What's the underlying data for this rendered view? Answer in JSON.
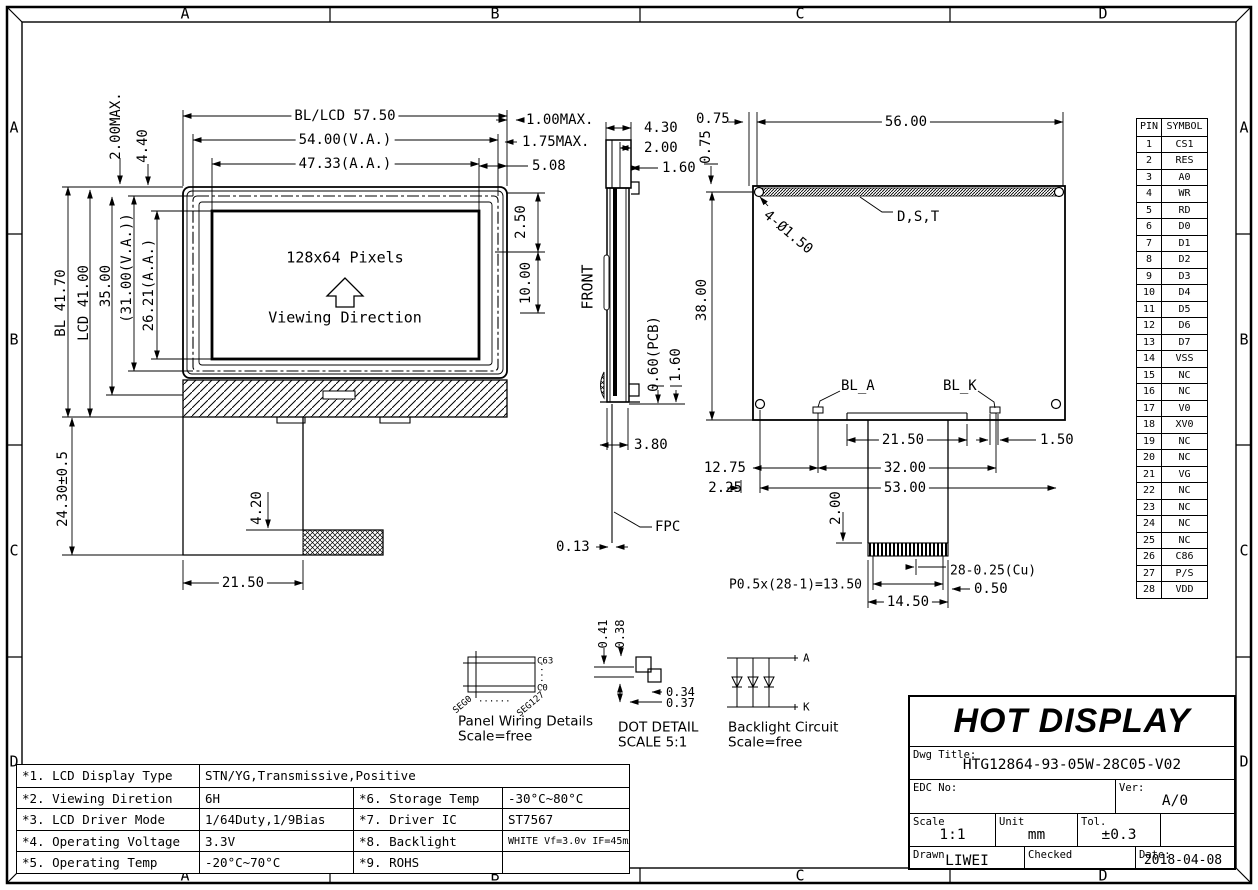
{
  "border": {
    "cols": [
      "A",
      "B",
      "C",
      "D"
    ],
    "rows": [
      "A",
      "B",
      "C",
      "D"
    ]
  },
  "front_view": {
    "screen_line1": "128x64 Pixels",
    "screen_line2": "Viewing Direction",
    "dims": {
      "bl_lcd_w": "BL/LCD 57.50",
      "va_w": "54.00(V.A.)",
      "aa_w": "47.33(A.A.)",
      "top_gap": "2.00MAX.",
      "bezel_top": "4.40",
      "bl_h": "BL 41.70",
      "lcd_h": "LCD 41.00",
      "pcb_h": "35.00",
      "va_h": "(31.00(V.A.))",
      "aa_h": "26.21(A.A.)",
      "tail_len": "24.30±0.5",
      "tail_w": "21.50",
      "conn_h": "4.20"
    }
  },
  "side_view": {
    "label_front": "FRONT",
    "label_fpc": "FPC",
    "dims": {
      "d100": "1.00MAX.",
      "d175": "1.75MAX.",
      "d508": "5.08",
      "d430": "4.30",
      "d200": "2.00",
      "d160": "1.60",
      "d250": "2.50",
      "d1000": "10.00",
      "pcb_t": "0.60(PCB)",
      "total_t": "1.60",
      "d380": "3.80",
      "fpc_t": "0.13"
    }
  },
  "back_view": {
    "labels": {
      "dst": "D,S,T",
      "holes": "4-Ø1.50",
      "bl_a": "BL_A",
      "bl_k": "BL_K"
    },
    "dims": {
      "d075h": "0.75",
      "d075v": "0.75",
      "d5600": "56.00",
      "d3800": "38.00",
      "d2150": "21.50",
      "d150": "1.50",
      "d3200": "32.00",
      "d1275": "12.75",
      "d5300": "53.00",
      "d225": "2.25",
      "d200": "2.00",
      "pitch": "P0.5x(28-1)=13.50",
      "cu": "28-0.25(Cu)",
      "d050": "0.50",
      "d1450": "14.50"
    }
  },
  "pin_table": {
    "headers": [
      "PIN",
      "SYMBOL"
    ],
    "rows": [
      [
        "1",
        "CS1"
      ],
      [
        "2",
        "RES"
      ],
      [
        "3",
        "A0"
      ],
      [
        "4",
        "WR"
      ],
      [
        "5",
        "RD"
      ],
      [
        "6",
        "D0"
      ],
      [
        "7",
        "D1"
      ],
      [
        "8",
        "D2"
      ],
      [
        "9",
        "D3"
      ],
      [
        "10",
        "D4"
      ],
      [
        "11",
        "D5"
      ],
      [
        "12",
        "D6"
      ],
      [
        "13",
        "D7"
      ],
      [
        "14",
        "VSS"
      ],
      [
        "15",
        "NC"
      ],
      [
        "16",
        "NC"
      ],
      [
        "17",
        "V0"
      ],
      [
        "18",
        "XV0"
      ],
      [
        "19",
        "NC"
      ],
      [
        "20",
        "NC"
      ],
      [
        "21",
        "VG"
      ],
      [
        "22",
        "NC"
      ],
      [
        "23",
        "NC"
      ],
      [
        "24",
        "NC"
      ],
      [
        "25",
        "NC"
      ],
      [
        "26",
        "C86"
      ],
      [
        "27",
        "P/S"
      ],
      [
        "28",
        "VDD"
      ]
    ]
  },
  "details": {
    "panel": {
      "title": "Panel Wiring Details",
      "scale": "Scale=free",
      "c_top": "C63",
      "c_bottom": "C0",
      "seg_left": "SEG0",
      "seg_right": "SEG127",
      "dots_h": "......",
      "dots_v": "....."
    },
    "dot": {
      "title": "DOT DETAIL",
      "scale": "SCALE 5:1",
      "d041": "0.41",
      "d038": "0.38",
      "d034": "0.34",
      "d037": "0.37"
    },
    "backlight": {
      "title": "Backlight Circuit",
      "scale": "Scale=free",
      "anode": "A",
      "cathode": "K"
    }
  },
  "spec_table": {
    "rows": [
      {
        "label": "*1. LCD Display Type",
        "value": "STN/YG,Transmissive,Positive",
        "label2": "",
        "value2": ""
      },
      {
        "label": "*2. Viewing Diretion",
        "value": "6H",
        "label2": "*6. Storage Temp",
        "value2": "-30°C~80°C"
      },
      {
        "label": "*3. LCD Driver Mode",
        "value": "1/64Duty,1/9Bias",
        "label2": "*7. Driver IC",
        "value2": "ST7567"
      },
      {
        "label": "*4. Operating Voltage",
        "value": "3.3V",
        "label2": "*8. Backlight",
        "value2": "WHITE Vf=3.0v IF=45mA"
      },
      {
        "label": "*5. Operating Temp",
        "value": "-20°C~70°C",
        "label2": "*9. ROHS",
        "value2": ""
      }
    ]
  },
  "title_block": {
    "company": "HOT DISPLAY",
    "dwg_title_label": "Dwg Title:",
    "dwg_title": "HTG12864-93-05W-28C05-V02",
    "edc_label": "EDC No:",
    "ver_label": "Ver:",
    "ver": "A/0",
    "scale_label": "Scale",
    "scale": "1:1",
    "unit_label": "Unit",
    "unit": "mm",
    "tol_label": "Tol.",
    "tol": "±0.3",
    "drawn_label": "Drawn",
    "drawn": "LIWEI",
    "checked_label": "Checked",
    "checked": "",
    "date_label": "Date:",
    "date": "2018-04-08"
  }
}
